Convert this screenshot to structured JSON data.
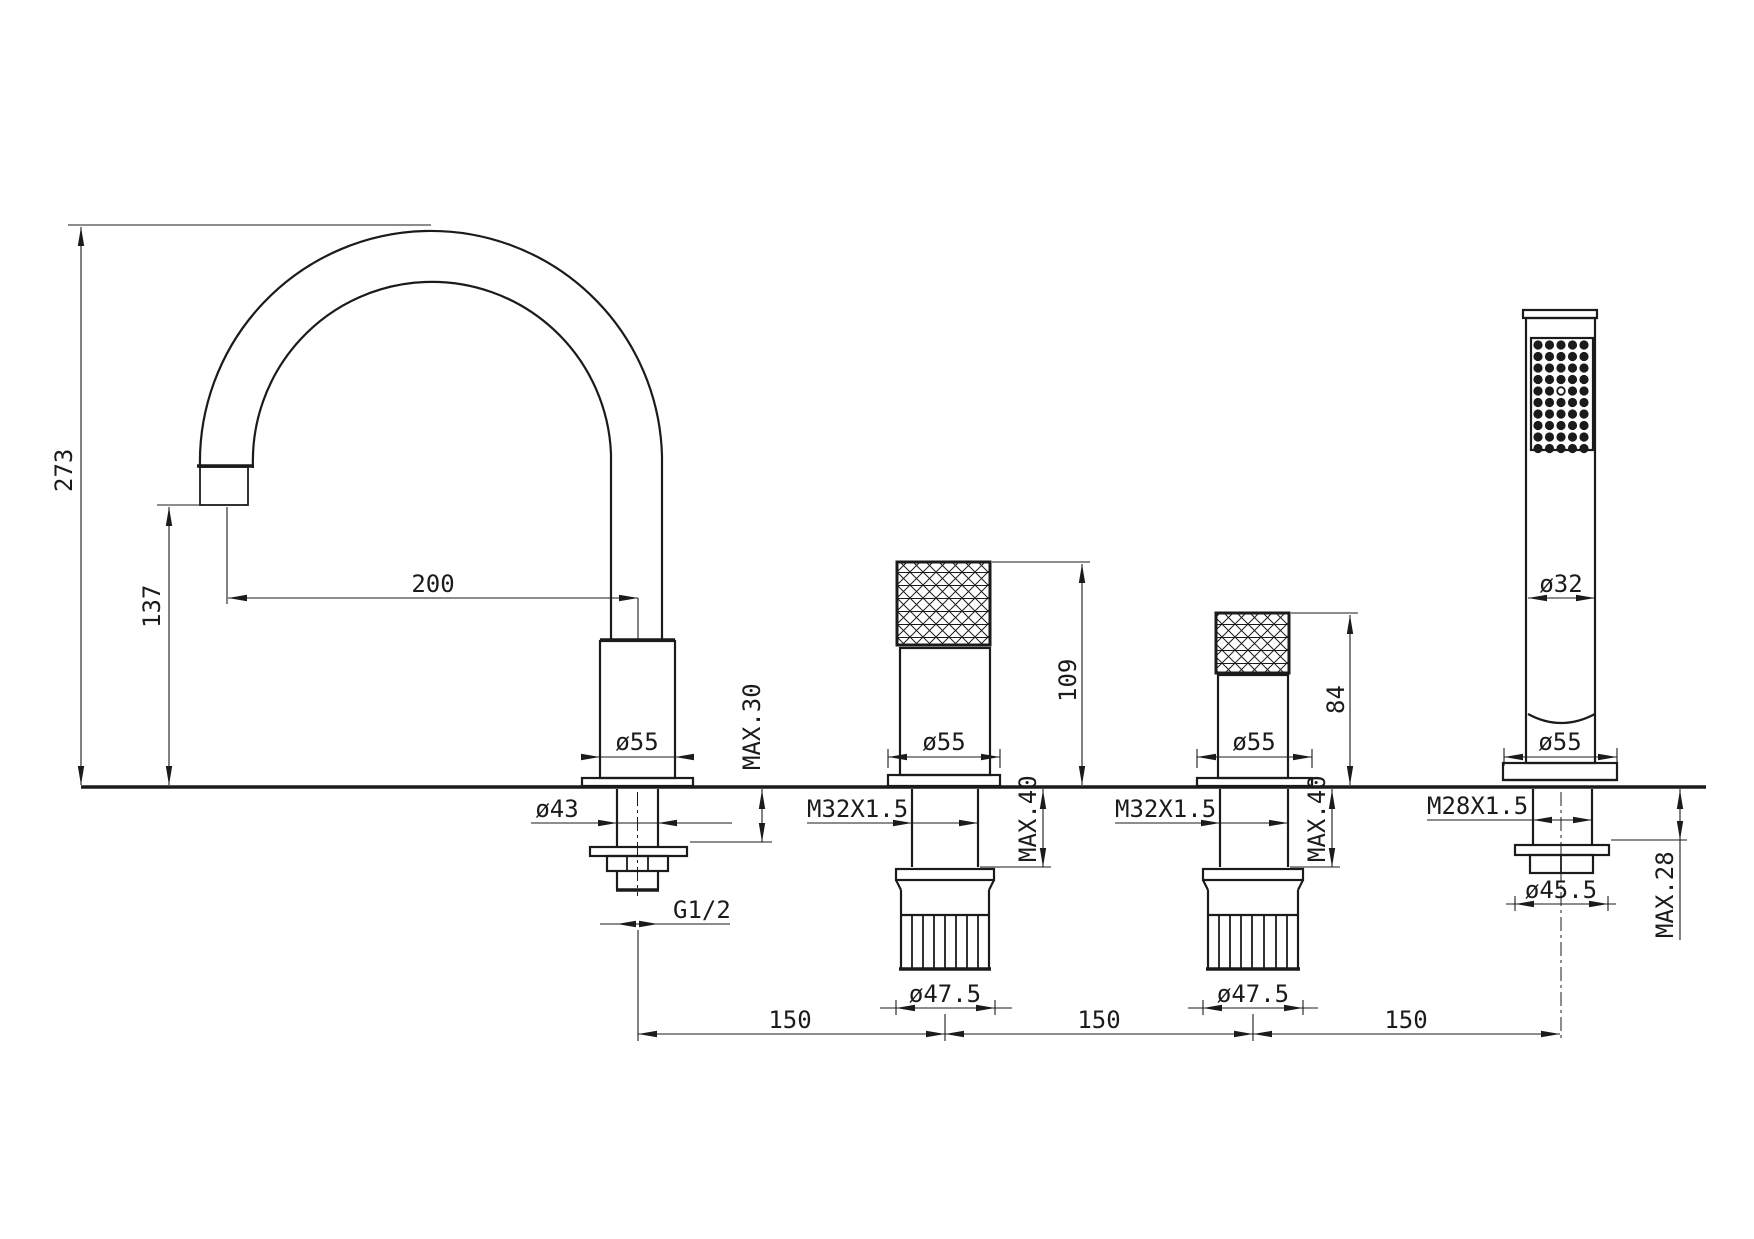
{
  "drawing": {
    "subject": "Deck-mounted 4-hole bathtub mixer: swivel spout, two knurled handles, pull-out hand shower",
    "line_color": "#1b1b1b",
    "background": "#ffffff"
  },
  "spout": {
    "height": "273",
    "reach": "200",
    "outlet_height": "137",
    "base_diameter": "ø55",
    "shank_diameter": "ø43",
    "thread": "G1/2",
    "max_deck": "MAX.30"
  },
  "handle1": {
    "height": "109",
    "base_diameter": "ø55",
    "thread": "M32X1.5",
    "max_deck": "MAX.40",
    "nut_diameter": "ø47.5"
  },
  "handle2": {
    "height": "84",
    "base_diameter": "ø55",
    "thread": "M32X1.5",
    "max_deck": "MAX.40",
    "nut_diameter": "ø47.5"
  },
  "hand_shower": {
    "handle_diameter": "ø32",
    "base_diameter": "ø55",
    "thread": "M28X1.5",
    "max_deck": "MAX.28",
    "nut_diameter": "ø45.5",
    "spray_rows": 10,
    "spray_cols": 5,
    "open_hole_row": 5,
    "open_hole_col": 3
  },
  "spacing": {
    "s1": "150",
    "s2": "150",
    "s3": "150"
  }
}
